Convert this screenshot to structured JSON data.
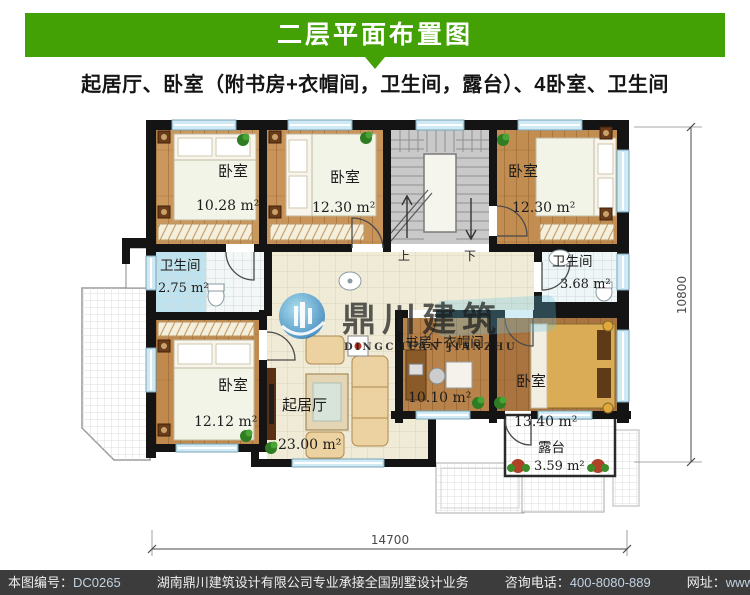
{
  "header": {
    "title": "二层平面布置图",
    "subtitle": "起居厅、卧室（附书房+衣帽间，卫生间，露台）、4卧室、卫生间"
  },
  "plan": {
    "rooms": {
      "bedroom_tl": {
        "name": "卧室",
        "area": "10.28 m²"
      },
      "bedroom_t2": {
        "name": "卧室",
        "area": "12.30 m²"
      },
      "bedroom_tr": {
        "name": "卧室",
        "area": "12.30 m²"
      },
      "bath_left": {
        "name": "卫生间",
        "area": "2.75 m²"
      },
      "bath_right": {
        "name": "卫生间",
        "area": "3.68 m²"
      },
      "bedroom_bl": {
        "name": "卧室",
        "area": "12.12 m²"
      },
      "living": {
        "name": "起居厅",
        "area": "23.00 m²"
      },
      "study": {
        "name": "书房+衣帽间",
        "area": "10.10 m²"
      },
      "bedroom_br": {
        "name": "卧室",
        "area": "13.40 m²"
      },
      "terrace": {
        "name": "露台",
        "area": "3.59 m²"
      }
    },
    "stairs": {
      "up": "上",
      "down": "下"
    },
    "dimensions": {
      "width": "14700",
      "height": "10800"
    }
  },
  "watermark": {
    "cn": "鼎川建筑",
    "en": "DINGCHUAN JIANZHU"
  },
  "footer": {
    "no_label": "本图编号：",
    "no_value": "DC0265",
    "company": "湖南鼎川建筑设计有限公司专业承接全国别墅设计业务",
    "phone_label": "咨询电话：",
    "phone_value": "400-8080-889",
    "site_label": "网址：",
    "site_value": "www.bstzcs.com"
  },
  "colors": {
    "accent_green": "#43a005",
    "footer_bg": "#3c3c3c",
    "watermark_blue": "#3e96c4"
  }
}
